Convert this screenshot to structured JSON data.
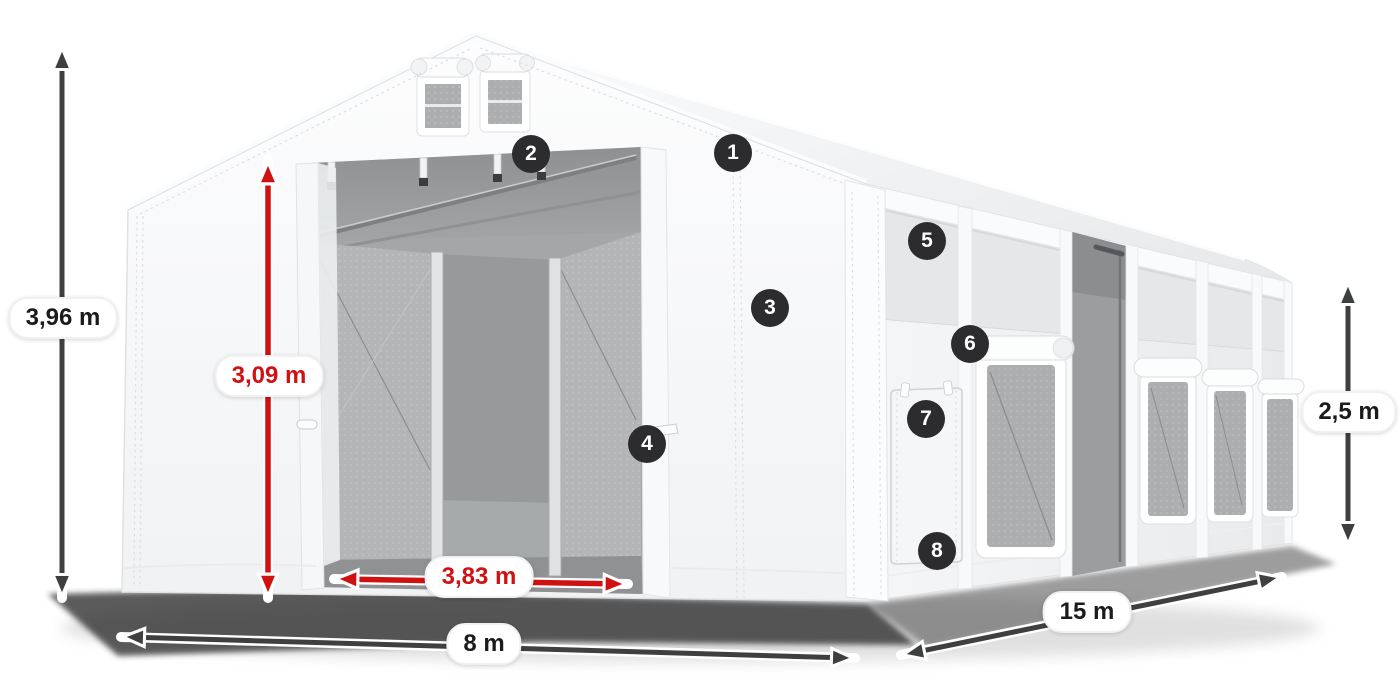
{
  "diagram": {
    "type": "product-dimension-diagram",
    "subject": "white modular storage tent with open gable entrance and windowed side wall",
    "colors": {
      "background": "#ffffff",
      "tent_white": "#fafbfc",
      "interior_gray": "#a4a6a8",
      "accent_red": "#d01111",
      "arrow_dark": "#3d3f41",
      "badge_background": "#2c2c2e",
      "badge_number": "#ffffff",
      "label_background": "#ffffff",
      "label_text": "#1b1b1b"
    },
    "dimensions": {
      "total_height": "3,96 m",
      "entrance_height": "3,09 m",
      "entrance_width": "3,83 m",
      "front_width": "8 m",
      "side_length": "15 m",
      "side_wall_height": "2,5 m"
    },
    "callouts": [
      "1",
      "2",
      "3",
      "4",
      "5",
      "6",
      "7",
      "8"
    ]
  }
}
